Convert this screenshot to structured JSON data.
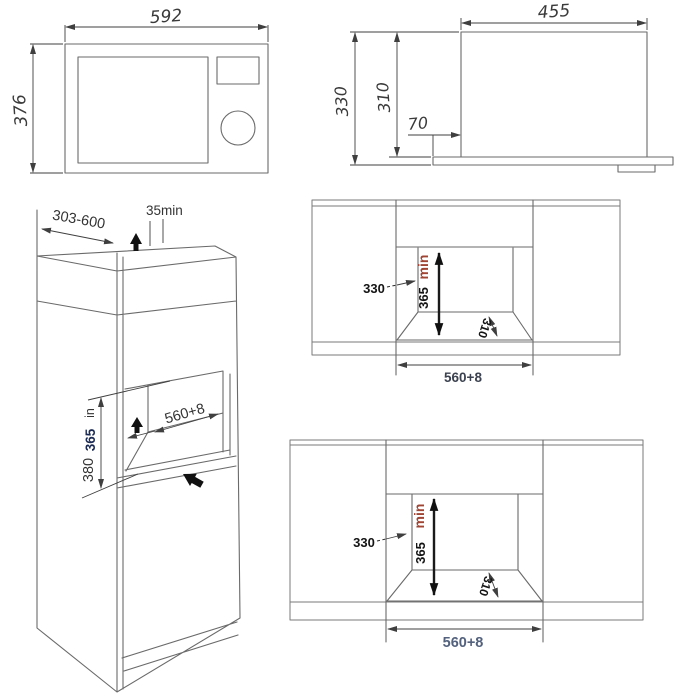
{
  "drawing": {
    "title": "built-in-microwave-installation-dimensions",
    "front_view": {
      "width_label": "592",
      "height_label": "376"
    },
    "side_view": {
      "depth_label": "455",
      "height_total_label": "330",
      "height_body_label": "310",
      "front_offset_label": "70"
    },
    "cabinet_view": {
      "depth_range_label": "303-600",
      "top_clearance_label": "35min",
      "niche_width_label": "560+8",
      "niche_min_height_label": "365",
      "niche_min_height_unit": "in",
      "niche_outer_height_label": "380"
    },
    "niche_top_view": {
      "side_depth_label": "330",
      "min_height_label": "365",
      "min_height_unit": "min",
      "rear_depth_label": "310",
      "width_label": "560+8"
    },
    "niche_bottom_view": {
      "side_depth_label": "330",
      "min_height_label": "365",
      "min_height_unit": "min",
      "rear_depth_label": "310",
      "width_label": "560+8"
    },
    "colors": {
      "line": "#6a6a6a",
      "dimension": "#3f3f3f",
      "min_text_red": "#a04434",
      "width_text_slate": "#53617d",
      "min_height_navy": "#1b2a52"
    }
  }
}
